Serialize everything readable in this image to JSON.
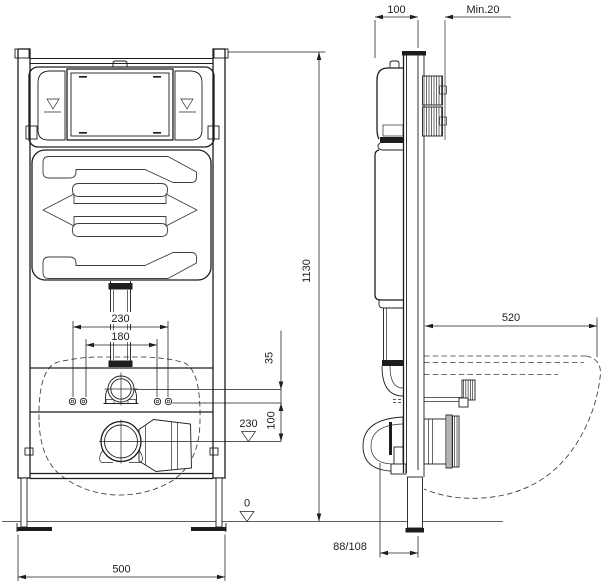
{
  "drawing": {
    "colors": {
      "line": "#1d1d1d",
      "background": "#ffffff"
    },
    "dims": {
      "front": {
        "bolt_spacing_outer": "230",
        "bolt_spacing_inner": "180",
        "flush_outlet_offset": "35",
        "flush_to_drain": "100",
        "drain_height_level": "230",
        "floor_level": "0",
        "total_height": "1130",
        "total_width": "500"
      },
      "side": {
        "frame_depth": "100",
        "wall_clearance_min": "Min.20",
        "bowl_depth": "520",
        "drain_offset": "88/108"
      }
    }
  }
}
